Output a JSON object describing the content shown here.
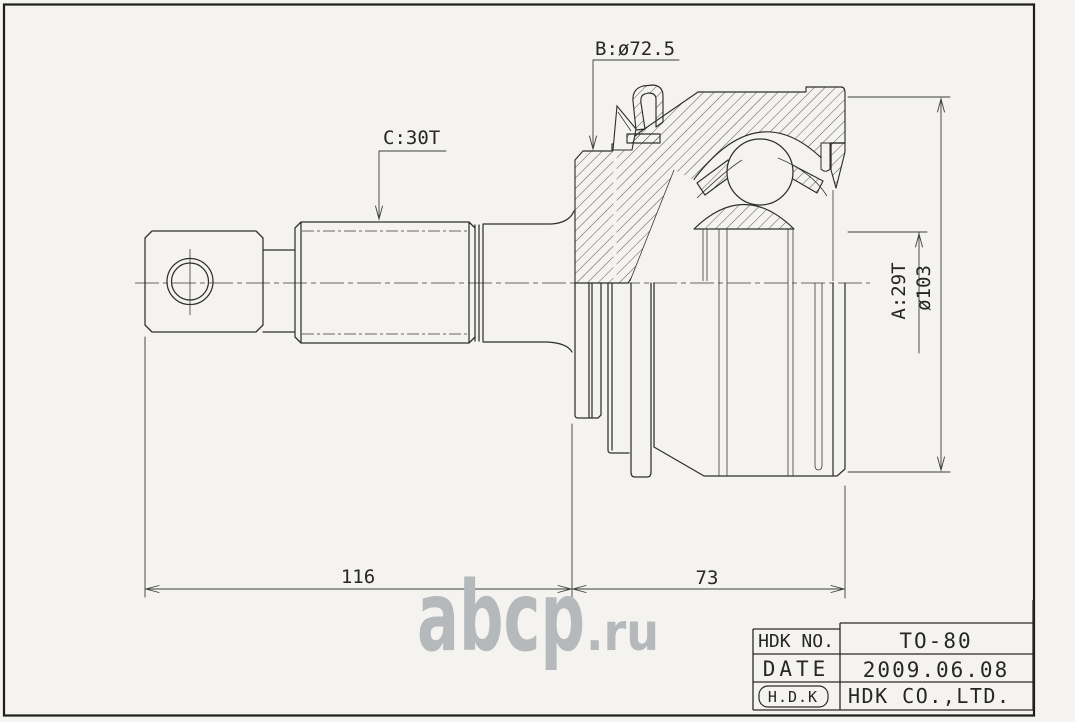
{
  "colors": {
    "paper": "#f4f3f0",
    "line": "#2e2e2e",
    "watermark": "#b5b9bc"
  },
  "drawing": {
    "labels": {
      "boot_diameter": "B:ø72.5",
      "shaft_spline": "C:30T",
      "outer_spline": "A:29T",
      "outer_diameter": "ø103"
    },
    "dimensions": {
      "shaft_length": "116",
      "joint_length": "73"
    }
  },
  "watermark": {
    "name": "abcp",
    "domain": ".ru"
  },
  "title_block": {
    "no_label": "HDK NO.",
    "no_value": "TO-80",
    "date_label": "DATE",
    "date_value": "2009.06.08",
    "logo": "H.D.K",
    "company": "HDK CO.,LTD."
  }
}
